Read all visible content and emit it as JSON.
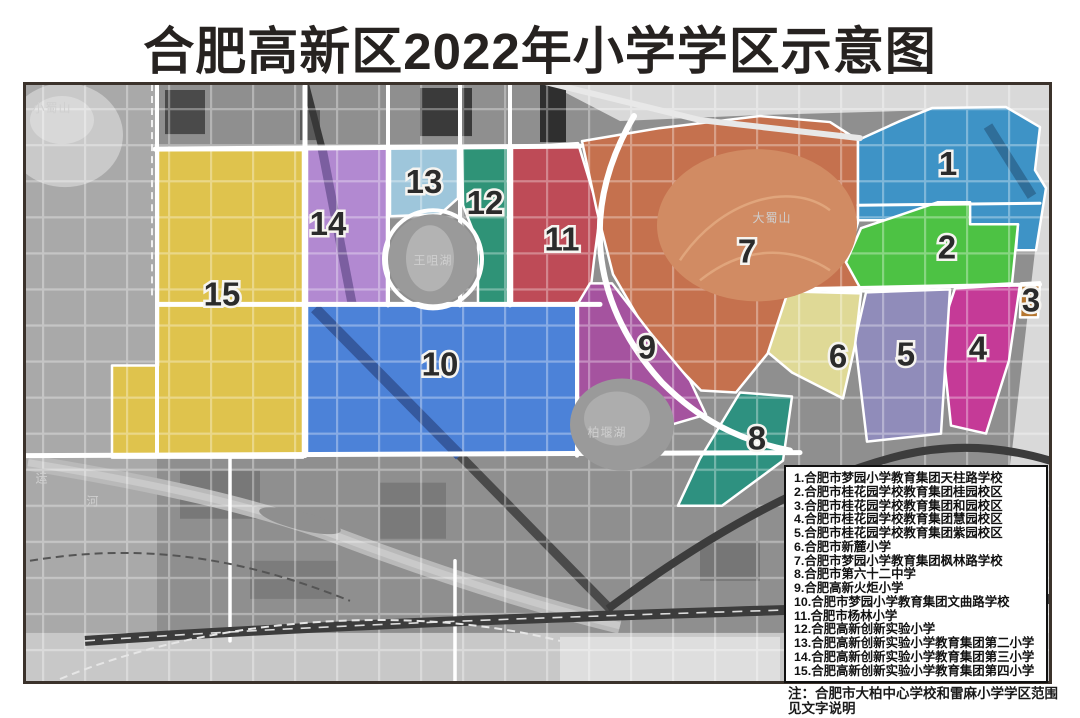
{
  "title": "合肥高新区2022年小学学区示意图",
  "note": {
    "line1": "注：合肥市大柏中心学校和雷麻小学学区范围",
    "line2": "见文字说明"
  },
  "map": {
    "regions": [
      {
        "num": "1",
        "school": "合肥市梦园小学教育集团天柱路学校",
        "color": "#3E93C6"
      },
      {
        "num": "2",
        "school": "合肥市桂花园学校教育集团桂园校区",
        "color": "#4DC244"
      },
      {
        "num": "3",
        "school": "合肥市桂花园学校教育集团和园校区",
        "color": "#B5762F"
      },
      {
        "num": "4",
        "school": "合肥市桂花园学校教育集团慧园校区",
        "color": "#C53A97"
      },
      {
        "num": "5",
        "school": "合肥市桂花园学校教育集团紫园校区",
        "color": "#908CBA"
      },
      {
        "num": "6",
        "school": "合肥市新麓小学",
        "color": "#DFD996"
      },
      {
        "num": "7",
        "school": "合肥市梦园小学教育集团枫林路学校",
        "color": "#C5714E"
      },
      {
        "num": "8",
        "school": "合肥市第六十二中学",
        "color": "#2E9180"
      },
      {
        "num": "9",
        "school": "合肥高新火炬小学",
        "color": "#A5539F"
      },
      {
        "num": "10",
        "school": "合肥市梦园小学教育集团文曲路学校",
        "color": "#4C82D8"
      },
      {
        "num": "11",
        "school": "合肥市杨林小学",
        "color": "#BE4B57"
      },
      {
        "num": "12",
        "school": "合肥高新创新实验小学",
        "color": "#2F9377"
      },
      {
        "num": "13",
        "school": "合肥高新创新实验小学教育集团第二小学",
        "color": "#9EC6DB"
      },
      {
        "num": "14",
        "school": "合肥高新创新实验小学教育集团第三小学",
        "color": "#B289D1"
      },
      {
        "num": "15",
        "school": "合肥高新创新实验小学教育集团第四小学",
        "color": "#DFC34D"
      }
    ],
    "places": [
      {
        "text": "小蜀山"
      },
      {
        "text": "王咀湖"
      },
      {
        "text": "大蜀山"
      },
      {
        "text": "柏堰湖"
      },
      {
        "text": "运"
      },
      {
        "text": "河"
      }
    ]
  }
}
